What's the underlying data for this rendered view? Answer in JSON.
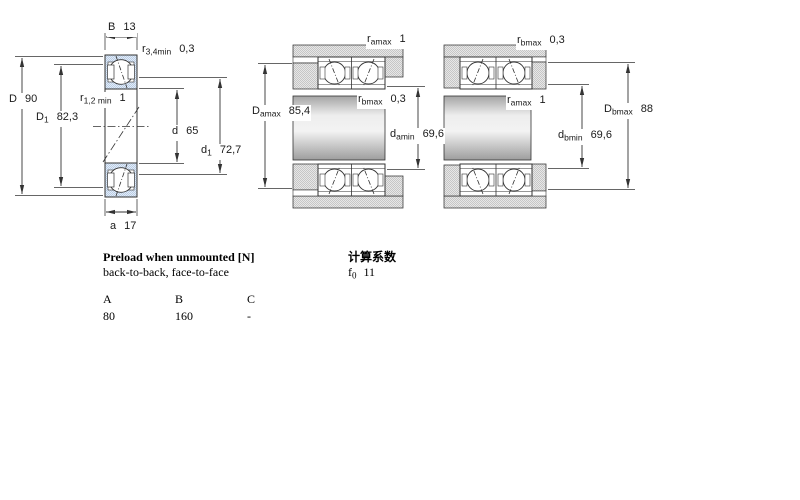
{
  "figures": {
    "left": {
      "name": "single bearing cross-section",
      "labels": {
        "B": {
          "pre": "B",
          "sub": "",
          "val": "13"
        },
        "r34": {
          "pre": "r",
          "sub": "3,4min",
          "val": "0,3"
        },
        "D": {
          "pre": "D",
          "sub": "",
          "val": "90"
        },
        "D1": {
          "pre": "D",
          "sub": "1",
          "val": "82,3"
        },
        "r12": {
          "pre": "r",
          "sub": "1,2 min",
          "val": "1"
        },
        "d": {
          "pre": "d",
          "sub": "",
          "val": "65"
        },
        "d1": {
          "pre": "d",
          "sub": "1",
          "val": "72,7"
        },
        "a": {
          "pre": "a",
          "sub": "",
          "val": "17"
        }
      }
    },
    "middle": {
      "name": "paired bearings back-to-back mounting",
      "labels": {
        "ramax": {
          "pre": "r",
          "sub": "amax",
          "val": "1"
        },
        "rbmax": {
          "pre": "r",
          "sub": "bmax",
          "val": "0,3"
        },
        "Damax": {
          "pre": "D",
          "sub": "amax",
          "val": "85,4"
        },
        "damin": {
          "pre": "d",
          "sub": "amin",
          "val": "69,6"
        }
      }
    },
    "right": {
      "name": "paired bearings face-to-face mounting",
      "labels": {
        "rbmax": {
          "pre": "r",
          "sub": "bmax",
          "val": "0,3"
        },
        "ramax": {
          "pre": "r",
          "sub": "amax",
          "val": "1"
        },
        "Dbmax": {
          "pre": "D",
          "sub": "bmax",
          "val": "88"
        },
        "dbmin": {
          "pre": "d",
          "sub": "bmin",
          "val": "69,6"
        }
      }
    }
  },
  "preload": {
    "title": "Preload when unmounted [N]",
    "subtitle": "back-to-back, face-to-face",
    "columns": [
      "A",
      "B",
      "C"
    ],
    "values": [
      "80",
      "160",
      "-"
    ]
  },
  "factors": {
    "title": "计算系数",
    "f0": {
      "pre": "f",
      "sub": "0",
      "val": "11"
    }
  },
  "colors": {
    "bearing_blue": "#ccdaeb",
    "line": "#333333",
    "housing_gray": "#d8d8d8"
  }
}
